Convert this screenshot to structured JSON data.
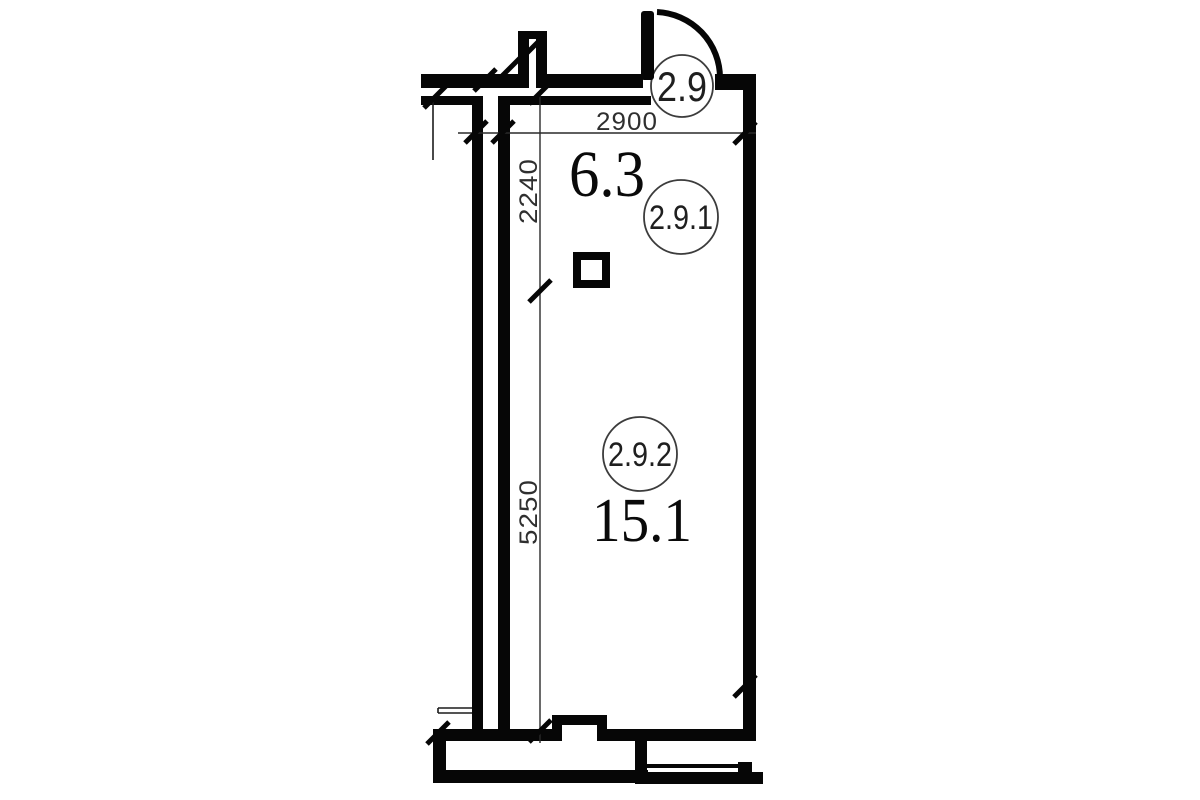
{
  "plan": {
    "type": "architectural floor plan",
    "rooms": [
      {
        "tag": "2.9"
      },
      {
        "tag": "2.9.1",
        "area": "6.3"
      },
      {
        "tag": "2.9.2",
        "area": "15.1"
      }
    ],
    "dimensions": {
      "top_width": "2900",
      "upper_height": "2240",
      "lower_height": "5250"
    },
    "colors": {
      "wall": "#060606",
      "dimension_text": "#2f2f2f",
      "background": "#ffffff"
    }
  }
}
